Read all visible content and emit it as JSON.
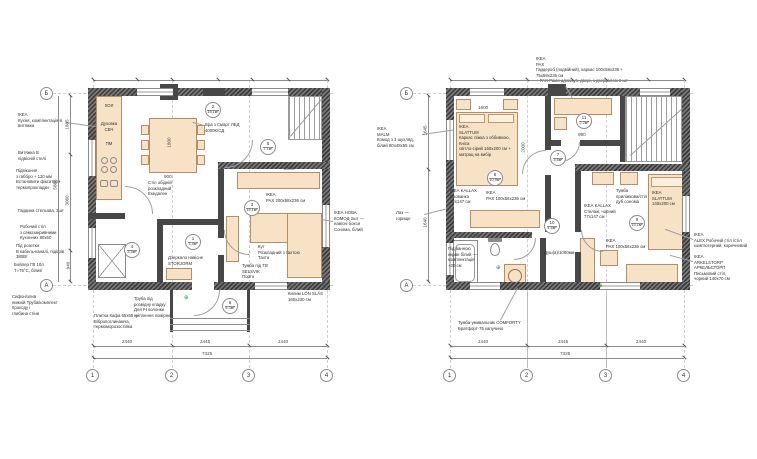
{
  "symbols": {
    "outlet": "⊕"
  },
  "plan1": {
    "grid": {
      "g1": "1",
      "g2": "2",
      "g3": "3",
      "g4": "4",
      "ga": "А",
      "gb": "Б"
    },
    "rooms": {
      "r1": {
        "num": "1",
        "area": "3,4м²"
      },
      "r2": {
        "num": "2",
        "area": "18,1м²"
      },
      "r3": {
        "num": "3",
        "area": "15,1м²"
      },
      "r4": {
        "num": "4",
        "area": "3,5м²"
      },
      "r5": {
        "num": "5",
        "area": "7,1м²"
      },
      "r6": {
        "num": "6",
        "area": "5,3м²"
      }
    },
    "kitchen": {
      "fridge": "ХОЛ",
      "oven": "Духовка\nСВЧ",
      "dishwasher": "ПМ"
    },
    "labels": {
      "dining_table": "Стіл обідній\nрозкладний\nЕкедален",
      "sconce": "Бра з Смарт ЛЕД\n4000К/СД",
      "wardrobe": "ІКЕА\nPAX 200x58x236 см",
      "sofa": "Кут\nРозкладний з тахтою\nТахта",
      "tv_stand": "Тумба під ТВ SELSVIK\nПорто",
      "rug": "Килим LÖN SLÄS\n160x230 см",
      "mirror": "Дзеркало навісне\nSTORJORM"
    },
    "notes_left": {
      "n1": "ІКЕА\nКухня, комплектація й\nвитяжка",
      "n2": "Витяжка В\nпідвісній стелі",
      "n3": "Підвіконня\nз габбро + 120 мм\nВстановити фіксатори\nтермопрокладки",
      "n4": "Гардина стельова, 2шт",
      "n5": "Робочий стіл\nз самозакривними\nКухонних 80x60",
      "n6": "Під розетки\nВ кабель-каналі, підігрів\n380Вт",
      "n7": "Бойлер ГВ 10л\nТ=75°С, білий",
      "n8": "Сифон/злив\nнижній Труба/комплект\nпроходу і\nглибина стіни"
    },
    "notes_bottom": {
      "n9": "Труба під\nрозвідну кладку\nДля ІЧ колонки\nкріплення помірне",
      "n10": "Плитка Кафа 65x65 —\nВібропоглинаюча,\nтермоморозостійка"
    },
    "note_right": "ІКЕА НОВА\nКОМОД 2шт —\nнавісні бокси\nСонома, білий",
    "dims": {
      "d12": "2440",
      "d23": "2445",
      "d34": "2440",
      "total": "7325",
      "v1": "1885",
      "v2": "3060",
      "v3": "940",
      "vtotal": "5885",
      "table_w": "1800",
      "table_d": "900",
      "pax_w": "2000"
    }
  },
  "plan2": {
    "grid": {
      "g1": "1",
      "g2": "2",
      "g3": "3",
      "g4": "4",
      "ga": "А",
      "gb": "Б"
    },
    "rooms": {
      "r7": {
        "num": "7",
        "area": "3,6м²"
      },
      "r8": {
        "num": "8",
        "area": "10,9м²"
      },
      "r9": {
        "num": "9",
        "area": "13,1м²"
      },
      "r10": {
        "num": "10",
        "area": "4,6м²"
      },
      "r11": {
        "num": "11",
        "area": "2,2м²"
      }
    },
    "labels": {
      "note_top": "ІКЕА\nPAX\nГардероб (подвійний), каркас 100x58x236 +\n75x58x236 см\n+ PAX Рами д/розсув. двері, з дзеркалом 2 шт",
      "bed1": "ІКЕА\nSLATTUM\nКаркас ліжка з оббивкою, Кніса\nсвітло-сірий 160x200 см +\nматрац на вибір",
      "malm": "ІКЕА\nMALM\nКомод з 3 шухляд,\nбілий 80x48x55 см",
      "hatch": "Лаз —\nгорище",
      "kallax1": "ІКЕА KALLAX\nСхованка\n42x147 см",
      "pax_small": "ІКЕА\nPAX 100x58x236 см",
      "kallax2": "ІКЕА KALLAX\nСтелаж, чорний\n77x147 см",
      "nightstand": "Тумба\nприліжкова/стіл\nдуб сонома",
      "bed2": "ІКЕА\nSLATTUM\n140x200 см",
      "alex": "ІКЕА\nALEX Робочий стіл /стіл\nкомп'ютерний, коричневий",
      "arkelstorp": "ІКЕА\nARKELSTORP АРКЕЛЬСТОРП\nПисьмовий стіл,\nчорний 140x70 см",
      "vanity": "Тумба-умивальник COMFORTY\nБратфорт-75 капучино",
      "tub": "Під ванною\nекран білий —\nкомплектація\n+30 см",
      "shower": "Душ(а)/1000мм"
    },
    "dims": {
      "d12": "2440",
      "d23": "2445",
      "d34": "2440",
      "total": "7325",
      "v1": "1645",
      "v2": "1640",
      "closet": "990",
      "bath1": "1370",
      "bath2": "600",
      "bed1_w": "1600",
      "bed1_l": "2000"
    }
  }
}
